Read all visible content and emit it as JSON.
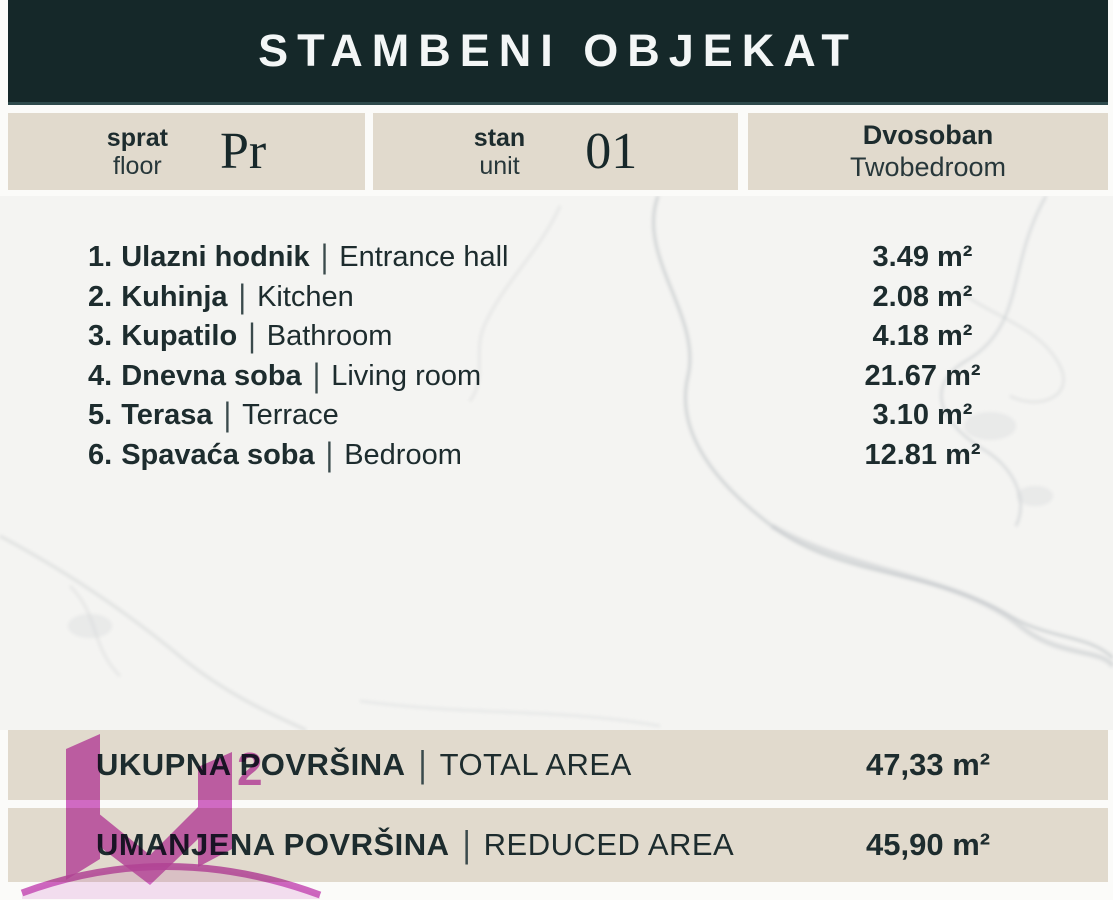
{
  "header": {
    "title": "STAMBENI OBJEKAT"
  },
  "separator": "|",
  "info_boxes": [
    {
      "label_sr": "sprat",
      "label_en": "floor",
      "value": "Pr"
    },
    {
      "label_sr": "stan",
      "label_en": "unit",
      "value": "01"
    },
    {
      "label_sr": "Dvosoban",
      "label_en": "Twobedroom"
    }
  ],
  "rooms": [
    {
      "num": "1.",
      "name_sr": "Ulazni hodnik",
      "name_en": "Entrance hall",
      "area": "3.49 m²"
    },
    {
      "num": "2.",
      "name_sr": "Kuhinja",
      "name_en": "Kitchen",
      "area": "2.08 m²"
    },
    {
      "num": "3.",
      "name_sr": "Kupatilo",
      "name_en": "Bathroom",
      "area": "4.18 m²"
    },
    {
      "num": "4.",
      "name_sr": "Dnevna soba",
      "name_en": "Living room",
      "area": "21.67 m²"
    },
    {
      "num": "5.",
      "name_sr": "Terasa",
      "name_en": "Terrace",
      "area": "3.10 m²"
    },
    {
      "num": "6.",
      "name_sr": "Spavaća soba",
      "name_en": "Bedroom",
      "area": "12.81 m²"
    }
  ],
  "totals": [
    {
      "label_sr": "UKUPNA POVRŠINA",
      "label_en": "TOTAL AREA",
      "value": "47,33 m²"
    },
    {
      "label_sr": "UMANJENA POVRŠINA",
      "label_en": "REDUCED AREA",
      "value": "45,90 m²"
    }
  ],
  "logo": {
    "superscript": "2"
  },
  "colors": {
    "header_bg": "#152829",
    "panel_bg": "#e1dacd",
    "text": "#1d2c2e",
    "marble_bg": "#f4f4f2",
    "logo_pink": "#cf58c0"
  }
}
